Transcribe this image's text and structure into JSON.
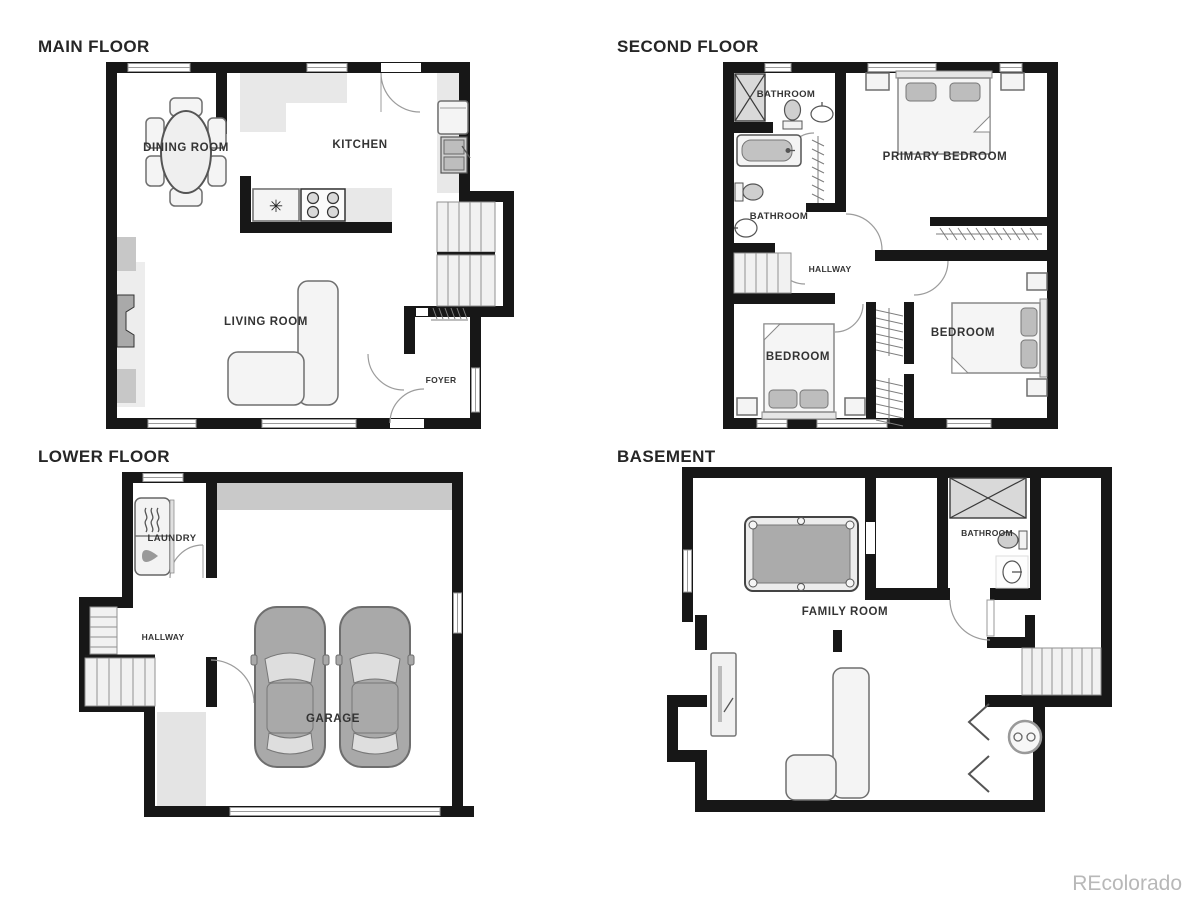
{
  "watermark": "REcolorado",
  "icons": {
    "refrigerator_star": "✳"
  },
  "colors": {
    "background": "#ffffff",
    "wall": "#171717",
    "furniture_fill": "#f4f4f4",
    "fixture_gray": "#d9d9d9",
    "accent_gray": "#c9c9c9",
    "label": "#343434",
    "watermark": "#b8b8b8"
  },
  "floors": [
    {
      "id": "main",
      "title": "MAIN FLOOR",
      "rooms": [
        "DINING ROOM",
        "KITCHEN",
        "LIVING ROOM",
        "FOYER"
      ]
    },
    {
      "id": "second",
      "title": "SECOND FLOOR",
      "rooms": [
        "BATHROOM",
        "PRIMARY BEDROOM",
        "BATHROOM",
        "HALLWAY",
        "BEDROOM",
        "BEDROOM"
      ]
    },
    {
      "id": "lower",
      "title": "LOWER FLOOR",
      "rooms": [
        "LAUNDRY",
        "HALLWAY",
        "GARAGE"
      ]
    },
    {
      "id": "basement",
      "title": "BASEMENT",
      "rooms": [
        "BATHROOM",
        "FAMILY ROOM"
      ]
    }
  ]
}
